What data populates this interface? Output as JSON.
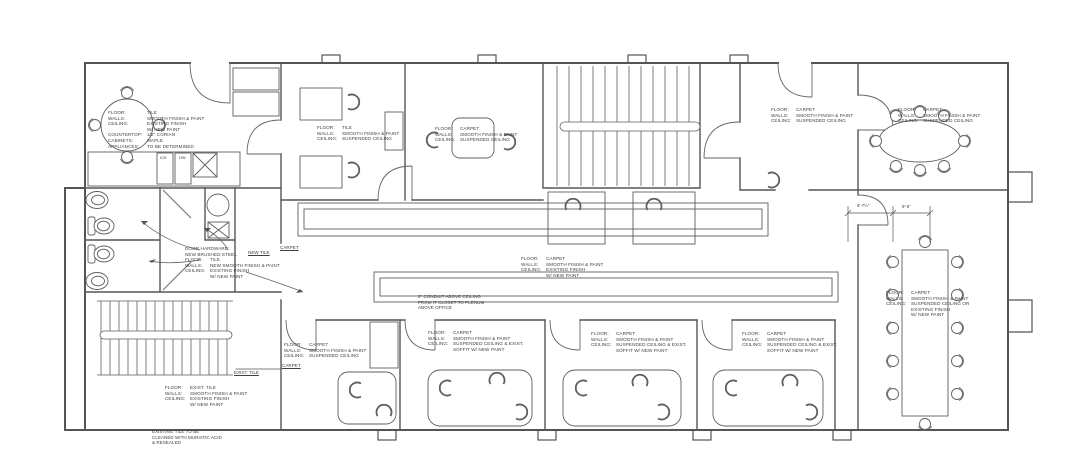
{
  "drawing": {
    "type": "architectural-floor-plan",
    "line_color": "#555555",
    "furniture_color": "#5f5f5f",
    "text_color": "#3f3f3f",
    "background": "#ffffff"
  },
  "annotations": {
    "kitchen": {
      "lines": [
        {
          "label": "FLOOR:",
          "value": "TILE"
        },
        {
          "label": "WALLS:",
          "value": "SMOOTH FINISH & PAINT"
        },
        {
          "label": "CEILING:",
          "value": "EXISTING FINISH\nW/ NEW PAINT"
        },
        {
          "label": "COUNTERTOP:",
          "value": "1/2\" CORIAN"
        },
        {
          "label": "CABINETS:",
          "value": "MAPLE"
        },
        {
          "label": "APPLIANCES:",
          "value": "TO BE DETERMINED"
        }
      ]
    },
    "office_tile": {
      "lines": [
        {
          "label": "FLOOR:",
          "value": "TILE"
        },
        {
          "label": "WALLS:",
          "value": "SMOOTH FINISH & PAINT"
        },
        {
          "label": "CEILING:",
          "value": "SUSPENDED CEILING"
        }
      ]
    },
    "office_carpet_top": {
      "lines": [
        {
          "label": "FLOOR:",
          "value": "CARPET"
        },
        {
          "label": "WALLS:",
          "value": "SMOOTH FINISH & PAINT"
        },
        {
          "label": "CEILING:",
          "value": "SUSPENDED CEILING"
        }
      ]
    },
    "office_d": {
      "lines": [
        {
          "label": "FLOOR:",
          "value": "CARPET"
        },
        {
          "label": "WALLS:",
          "value": "SMOOTH FINISH & PAINT"
        },
        {
          "label": "CEILING:",
          "value": "SUSPENDED CEILING"
        }
      ]
    },
    "conference_upper": {
      "lines": [
        {
          "label": "FLOOR:",
          "value": "CARPET"
        },
        {
          "label": "WALLS:",
          "value": "SMOOTH FINISH & PAINT"
        },
        {
          "label": "CEILING:",
          "value": "SUSPENDED CEILING"
        }
      ]
    },
    "restrooms": {
      "lines": [
        {
          "label": "DOOR HARDWARE:",
          "value": ""
        },
        {
          "label": "NEW BRUSHED STEEL",
          "value": ""
        },
        {
          "label": "FLOOR:",
          "value": "TILE"
        },
        {
          "label": "WALLS:",
          "value": "NEW SMOOTH FINISH & PAINT"
        },
        {
          "label": "CEILING:",
          "value": "EXISTING FINISH\nW/ NEW PAINT"
        }
      ]
    },
    "corridor": {
      "lines": [
        {
          "label": "FLOOR:",
          "value": "CARPET"
        },
        {
          "label": "WALLS:",
          "value": "SMOOTH FINISH & PAINT"
        },
        {
          "label": "CEILING:",
          "value": "EXISTING FINISH\nW/ NEW PAINT"
        }
      ]
    },
    "office_b1": {
      "lines": [
        {
          "label": "FLOOR:",
          "value": "CARPET"
        },
        {
          "label": "WALLS:",
          "value": "SMOOTH FINISH & PAINT"
        },
        {
          "label": "CEILING:",
          "value": "SUSPENDED CEILING"
        }
      ]
    },
    "office_b2": {
      "lines": [
        {
          "label": "FLOOR:",
          "value": "CARPET"
        },
        {
          "label": "WALLS:",
          "value": "SMOOTH FINISH & PAINT"
        },
        {
          "label": "CEILING:",
          "value": "SUSPENDED CEILING & EXIST.\nSOFFIT W/ NEW PAINT"
        }
      ]
    },
    "office_b3": {
      "lines": [
        {
          "label": "FLOOR:",
          "value": "CARPET"
        },
        {
          "label": "WALLS:",
          "value": "SMOOTH FINISH & PAINT"
        },
        {
          "label": "CEILING:",
          "value": "SUSPENDED CEILING & EXIST.\nSOFFIT W/ NEW PAINT"
        }
      ]
    },
    "office_b4": {
      "lines": [
        {
          "label": "FLOOR:",
          "value": "CARPET"
        },
        {
          "label": "WALLS:",
          "value": "SMOOTH FINISH & PAINT"
        },
        {
          "label": "CEILING:",
          "value": "SUSPENDED CEILING & EXIST.\nSOFFIT W/ NEW PAINT"
        }
      ]
    },
    "conference_main": {
      "lines": [
        {
          "label": "FLOOR:",
          "value": "CARPET"
        },
        {
          "label": "WALLS:",
          "value": "SMOOTH FINISH & PAINT"
        },
        {
          "label": "CEILING:",
          "value": "SUSPENDED CEILING OR\nEXISTING FINISH\nW/ NEW PAINT"
        }
      ]
    },
    "stair_lobby": {
      "lines": [
        {
          "label": "FLOOR:",
          "value": "EXIST. TILE"
        },
        {
          "label": "WALLS:",
          "value": "SMOOTH FINISH & PAINT"
        },
        {
          "label": "CEILING:",
          "value": "EXISTING FINISH\nW/ NEW PAINT"
        }
      ]
    }
  },
  "notes": {
    "conduit": "2\" CONDUIT ABOVE CEILING\nFROM IT CLOSET TO PLENUM\nABOVE OFFICE",
    "existing_tile": "EXISTING TILE TO BE\nCLEANED WITH MURIATIC ACID\n& RESEALED"
  },
  "labels": {
    "new_tile": "NEW TILE",
    "carpet_upper": "CARPET",
    "exist_tile": "EXIST. TILE",
    "carpet_lower": "CARPET",
    "ice": "ICE",
    "dw": "DW"
  },
  "dimensions": {
    "d1": "8'-7½\"",
    "d2": "9'-6\""
  }
}
